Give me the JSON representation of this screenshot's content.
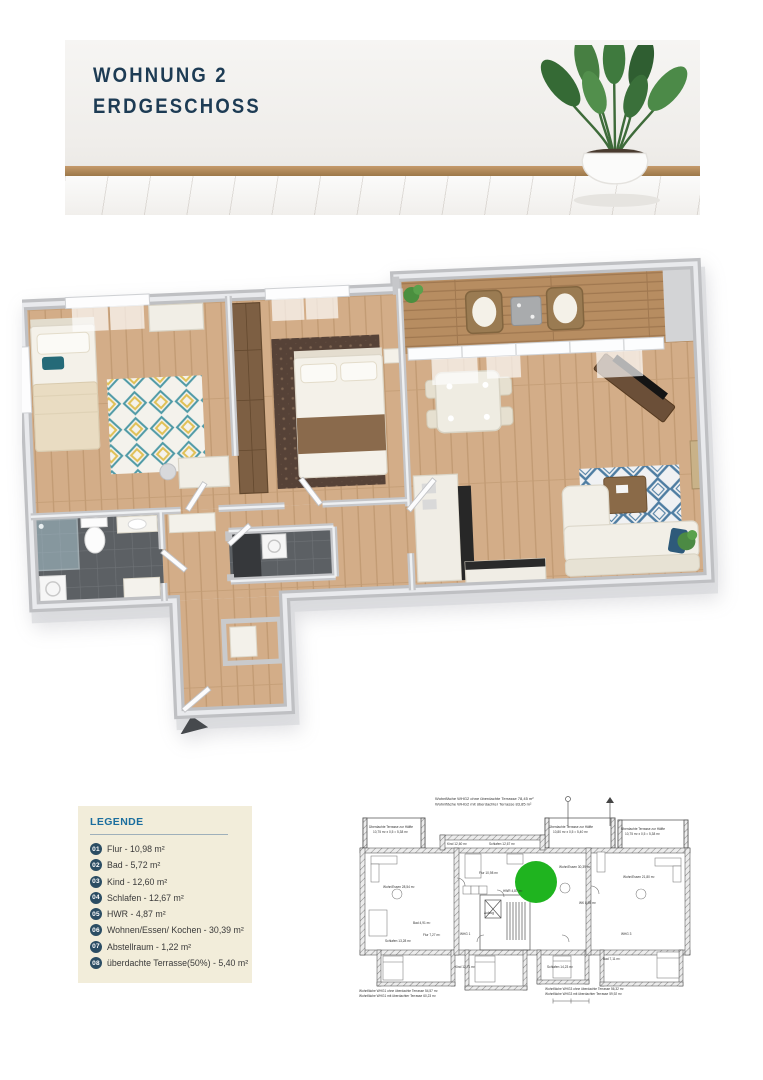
{
  "header": {
    "title_line1": "WOHNUNG 2",
    "title_line2": "ERDGESCHOSS"
  },
  "legend": {
    "title": "LEGENDE",
    "items": [
      {
        "num": "01",
        "label": "Flur - 10,98 m²"
      },
      {
        "num": "02",
        "label": "Bad - 5,72 m²"
      },
      {
        "num": "03",
        "label": "Kind - 12,60 m²"
      },
      {
        "num": "04",
        "label": "Schlafen - 12,67 m²"
      },
      {
        "num": "05",
        "label": "HWR - 4,87 m²"
      },
      {
        "num": "06",
        "label": "Wohnen/Essen/ Kochen - 30,39 m²"
      },
      {
        "num": "07",
        "label": "Abstellraum - 1,22 m²"
      },
      {
        "num": "08",
        "label": "überdachte Terrasse(50%) - 5,40 m²"
      }
    ]
  },
  "siteplan": {
    "top_note1": "Wohnfläche WHG2 ohne überdachte Terrasse  78,45 m²",
    "top_note2": "Wohnfläche WHG2 mit überdachter Terrasse  83,85 m²",
    "bottom_left_note1": "Wohnfläche WHG1 ohne überdachte Terrasse  54,57 m²",
    "bottom_left_note2": "Wohnfläche WHG1 mit überdachter Terrasse  60,23 m²",
    "bottom_right_note1": "Wohnfläche WHG3 ohne überdachte Terrasse  56,32 m²",
    "bottom_right_note2": "Wohnfläche WHG3 mit überdachter Terrasse  59,92 m²",
    "labels": [
      "Überdachte Terrasse zur Hälfte",
      "10,75 m² x 0,5 = 5,38 m²",
      "Überdachte Terrasse zur Hälfte",
      "10,80 m² x 0,5 = 5,40 m²",
      "Überdachte Terrasse zur Hälfte",
      "10,75 m² x 0,5 = 5,38 m²",
      "Wohn/Essen 28,54 m²",
      "Kind 12,60 m²",
      "Schlafen 12,67 m²",
      "Flur 10,98 m²",
      "HWR 4,87 m²",
      "Wohn/Essen 30,39 m²",
      "Wohn/Essen 21,80 m²",
      "Schlafen 14,23 m²",
      "Bad 7,11 m²",
      "Schlafen 13,28 m²",
      "Kind 12,71 m²",
      "Bad 4,91 m²",
      "Flur 7,27 m²",
      "Aufzug",
      "WK 8,98 m²",
      "WHG 1",
      "WHG 3"
    ]
  },
  "colors": {
    "accent_navy": "#1d3b54",
    "legend_background": "#f2edda",
    "legend_title_blue": "#1b6e9e",
    "legend_badge": "#2b4d63",
    "marker_green": "#1fb41f",
    "wood_floor": "#d3ad88",
    "terrace_deck": "#b78d61",
    "tile_dark": "#5c6064",
    "wall_gray": "#bfc0c3"
  }
}
